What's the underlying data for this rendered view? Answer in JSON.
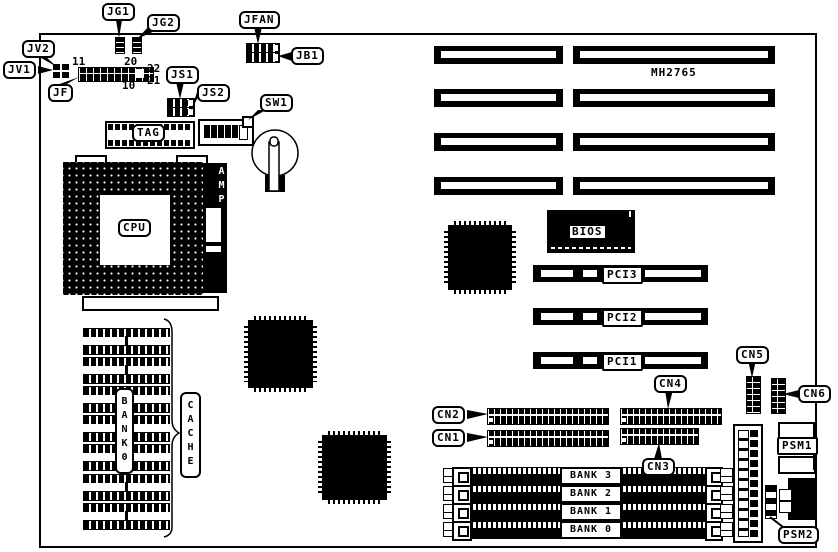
{
  "board": {
    "model": "MH2765"
  },
  "callouts": {
    "jg1": "JG1",
    "jg2": "JG2",
    "jfan": "JFAN",
    "jb1": "JB1",
    "jv2": "JV2",
    "jv1": "JV1",
    "jf": "JF",
    "js1": "JS1",
    "js2": "JS2",
    "sw1": "SW1",
    "tag": "TAG",
    "cpu": "CPU",
    "bios": "BIOS",
    "pci1": "PCI1",
    "pci2": "PCI2",
    "pci3": "PCI3",
    "cn1": "CN1",
    "cn2": "CN2",
    "cn3": "CN3",
    "cn4": "CN4",
    "cn5": "CN5",
    "cn6": "CN6",
    "psm1": "PSM1",
    "psm2": "PSM2"
  },
  "vertical_labels": {
    "amp": "AMP",
    "bank0": "BANK0",
    "cache": "CACHE"
  },
  "memory": {
    "simm_banks": [
      "BANK 3",
      "BANK 2",
      "BANK 1",
      "BANK 0"
    ]
  },
  "jf_pins": {
    "p11": "11",
    "p20": "20",
    "p10": "10",
    "p22": "22",
    "p21": "21"
  }
}
